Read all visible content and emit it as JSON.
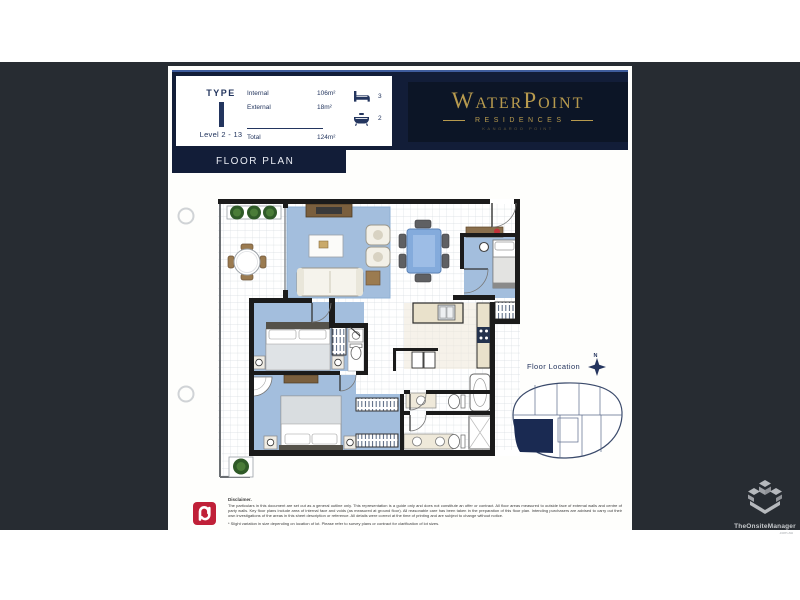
{
  "colors": {
    "background": "#272c32",
    "page": "#ffffff",
    "navy_band": "#121d38",
    "logo_panel": "#0c1526",
    "gold": "#b79a4e",
    "wall": "#1b1b1b",
    "carpet_blue": "#a3bedd",
    "brand_red": "#c02038"
  },
  "header": {
    "spec": {
      "type_label": "TYPE",
      "type_value": "I",
      "level_range": "Level 2 - 13",
      "areas": [
        {
          "label": "Internal",
          "value": "106m²"
        },
        {
          "label": "External",
          "value": "18m²"
        },
        {
          "label": "Total",
          "value": "124m²"
        }
      ],
      "bedrooms": "3",
      "bathrooms": "2"
    },
    "logo": {
      "t1": "W",
      "t2": "ATER",
      "t3": "P",
      "t4": "OINT",
      "subtitle": "RESIDENCES",
      "tagline": "KANGAROO POINT"
    }
  },
  "section_title": "FLOOR PLAN",
  "floor_location": {
    "label": "Floor Location",
    "compass": "N"
  },
  "disclaimer": {
    "heading": "Disclaimer.",
    "body": "The particulars in this document are set out as a general outline only. This representation is a guide only and does not constitute an offer or contract. All floor areas measured to outside face of external walls and centre of party walls. Key floor plans include area of internal face and voids (as measured at ground floor). All reasonable care has been taken in the preparation of this floor plan. Intending purchasers are advised to carry out their own investigations of the areas in this sheet description or reference. All details were correct at the time of printing and are subject to change without notice.",
    "note": "* Slight variation in size depending on location of lot. Please refer to survey plans or contract for clarification of lot sizes."
  },
  "watermark": {
    "brand": "TheOnsiteManager",
    "domain": ".com.au"
  }
}
